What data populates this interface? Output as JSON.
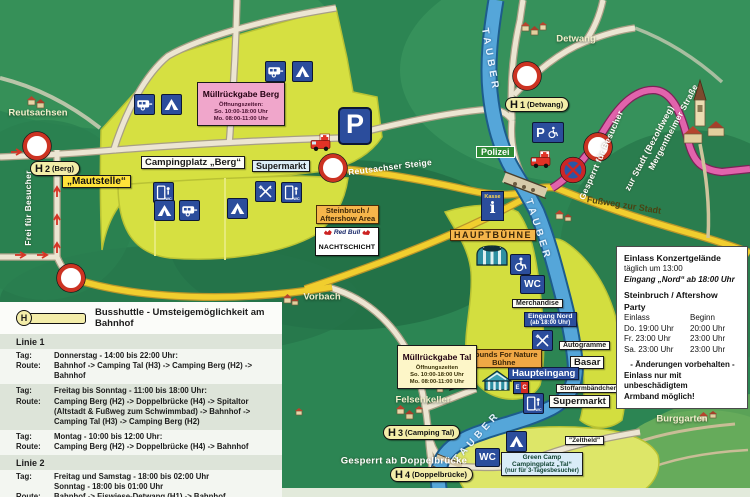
{
  "colors": {
    "map_green": "#2c8553",
    "camp_yellow": "#d6e041",
    "road_yellow": "#f1ce2e",
    "road_pink": "#e163ac",
    "river_blue": "#55a6d9",
    "icon_blue": "#2b4d9c",
    "label_orange": "#f6b64b",
    "pink_box": "#f0a6cb",
    "stop_pill": "#f3eda9"
  },
  "icons": {
    "wc": "WC",
    "parking": "P",
    "info": "i",
    "ec_e": "E",
    "ec_c": "C"
  },
  "map": {
    "river_label": "TAUBER",
    "villages": {
      "reutsachsen": "Reutsachsen",
      "detwang": "Detwang",
      "vorbach": "Vorbach",
      "felsenkeller": "Felsenkeller",
      "burggarten": "Burggarten"
    },
    "roads": {
      "reutsachser_steige": "Reutsachser Steige",
      "frei_fuer_besucher": "Frei für Besucher",
      "mergentheimer_strasse": "Mergentheimer Straße",
      "zur_stadt": "zur Stadt (Bezoldweg)",
      "gesperrt_fuer_besucher": "Gesperrt für Besucher",
      "fussweg_zur_stadt": "Fußweg zur Stadt",
      "gesperrt_ab_doppelbruecke": "Gesperrt ab Doppelbrücke"
    },
    "stops": {
      "letter": "H",
      "h1_num": "1",
      "h1_name": "(Detwang)",
      "h2_num": "2",
      "h2_name": "(Berg)",
      "h3_num": "3",
      "h3_name": "(Camping Tal)",
      "h4_num": "4",
      "h4_name": "(Doppelbrücke)"
    },
    "labels": {
      "mautstelle": "„Mautstelle“",
      "campingplatz_berg": "Campingplatz „Berg“",
      "supermarkt_berg": "Supermarkt",
      "supermarkt_tal": "Supermarkt",
      "polizei": "Polizei",
      "kasse": "Kasse",
      "hauptbuehne": "HAUPTBÜHNE",
      "steinbruch_1": "Steinbruch /",
      "steinbruch_2": "Aftershow Area",
      "redbull_1": "Red Bull",
      "redbull_2": "NACHTSCHICHT",
      "merchandise": "Merchandise",
      "eingang_nord_1": "Eingang Nord",
      "eingang_nord_2": "(ab 18:00 Uhr)",
      "autogramme": "Autogramme",
      "basar": "Basar",
      "stoffarmbaendchen": "Stoffarmbändchen",
      "haupteingang": "Haupteingang",
      "sfn_1": "Sounds For Nature",
      "sfn_2": "Bühne",
      "zeltheld": "\"Zeltheld\"",
      "green_camp_1": "Green Camp",
      "green_camp_2": "Campingplatz „Tal“",
      "green_camp_3": "(nur für 3-Tagesbesucher)"
    },
    "muell_berg": {
      "title": "Müllrückgabe Berg",
      "l1": "Öffnungszeiten:",
      "l2": "So. 10:00-18:00 Uhr",
      "l3": "Mo. 08:00-11:00 Uhr"
    },
    "muell_tal": {
      "title": "Müllrückgabe Tal",
      "l1": "Öffnungszeiten",
      "l2": "So. 10:00-18:00 Uhr",
      "l3": "Mo. 08:00-11:00 Uhr"
    }
  },
  "einlass": {
    "title1": "Einlass Konzertgelände",
    "line1": "täglich um 13:00",
    "line2": "Eingang „Nord“ ab 18:00 Uhr",
    "title2": "Steinbruch / Aftershow Party",
    "col_einlass": "Einlass",
    "col_beginn": "Beginn",
    "r1_a": "Do. 19:00 Uhr",
    "r1_b": "20:00 Uhr",
    "r2_a": "Fr.  23:00 Uhr",
    "r2_b": "23:00 Uhr",
    "r3_a": "Sa. 23:00 Uhr",
    "r3_b": "23:00 Uhr",
    "note1": "- Änderungen vorbehalten -",
    "note2": "Einlass nur mit unbeschädigtem",
    "note3": "Armband möglich!"
  },
  "shuttle": {
    "title": "Busshuttle - Umsteigemöglichkeit am Bahnhof",
    "tag_label": "Tag:",
    "route_label": "Route:",
    "linie1": "Linie 1",
    "linie2": "Linie 2",
    "e1_tag": "Donnerstag - 14:00 bis 22:00 Uhr:",
    "e1_route": "Bahnhof -> Camping Tal (H3) -> Camping Berg (H2) -> Bahnhof",
    "e2_tag": "Freitag bis Sonntag - 11:00 bis 18:00 Uhr:",
    "e2_route": "Camping Berg (H2) -> Doppelbrücke (H4) -> Spitaltor (Altstadt & Fußweg zum Schwimmbad) -> Bahnhof -> Camping Tal (H3) -> Camping Berg (H2)",
    "e3_tag": "Montag - 10:00 bis 12:00 Uhr:",
    "e3_route": "Camping Berg (H2) -> Doppelbrücke (H4) -> Bahnhof",
    "e4_tag1": "Freitag und Samstag - 18:00 bis 02:00 Uhr",
    "e4_tag2": "Sonntag - 18:00 bis 01:00 Uhr",
    "e4_route": "Bahnhof -> Eiswiese-Detwang (H1) -> Bahnhof"
  }
}
